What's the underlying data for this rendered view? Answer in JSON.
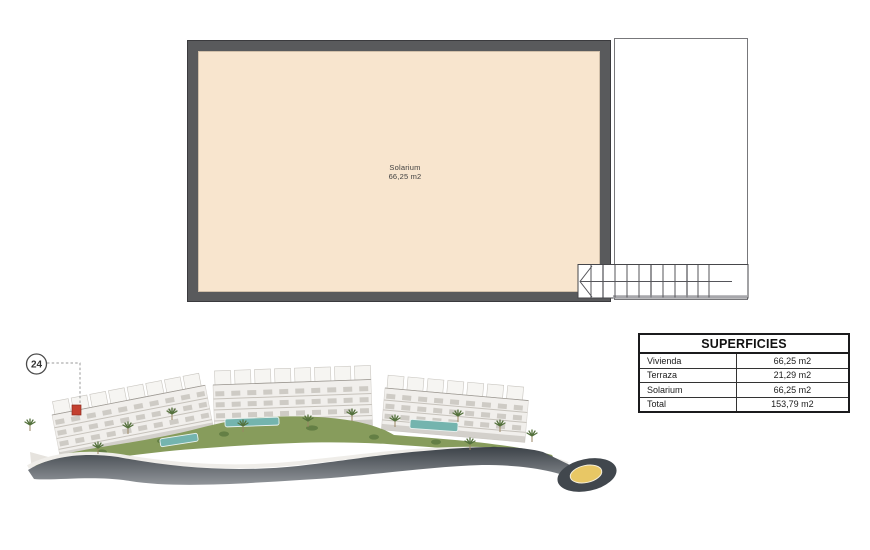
{
  "floor_plan": {
    "room": {
      "name": "Solarium",
      "area": "66,25 m2"
    },
    "colors": {
      "wall": "#595a5c",
      "floor": "#f8e5ce"
    }
  },
  "unit_badge": {
    "number": "24"
  },
  "superficies_table": {
    "title": "SUPERFICIES",
    "rows": [
      {
        "label": "Vivienda",
        "value": "66,25 m2"
      },
      {
        "label": "Terraza",
        "value": "21,29 m2"
      },
      {
        "label": "Solarium",
        "value": "66,25 m2"
      },
      {
        "label": "Total",
        "value": "153,79 m2"
      }
    ]
  },
  "render_colors": {
    "road": "#41474d",
    "lawn": "#879c5c",
    "pool": "#74b4ae",
    "roundabout_center": "#e8c765",
    "highlighted_unit": "#c44030"
  }
}
